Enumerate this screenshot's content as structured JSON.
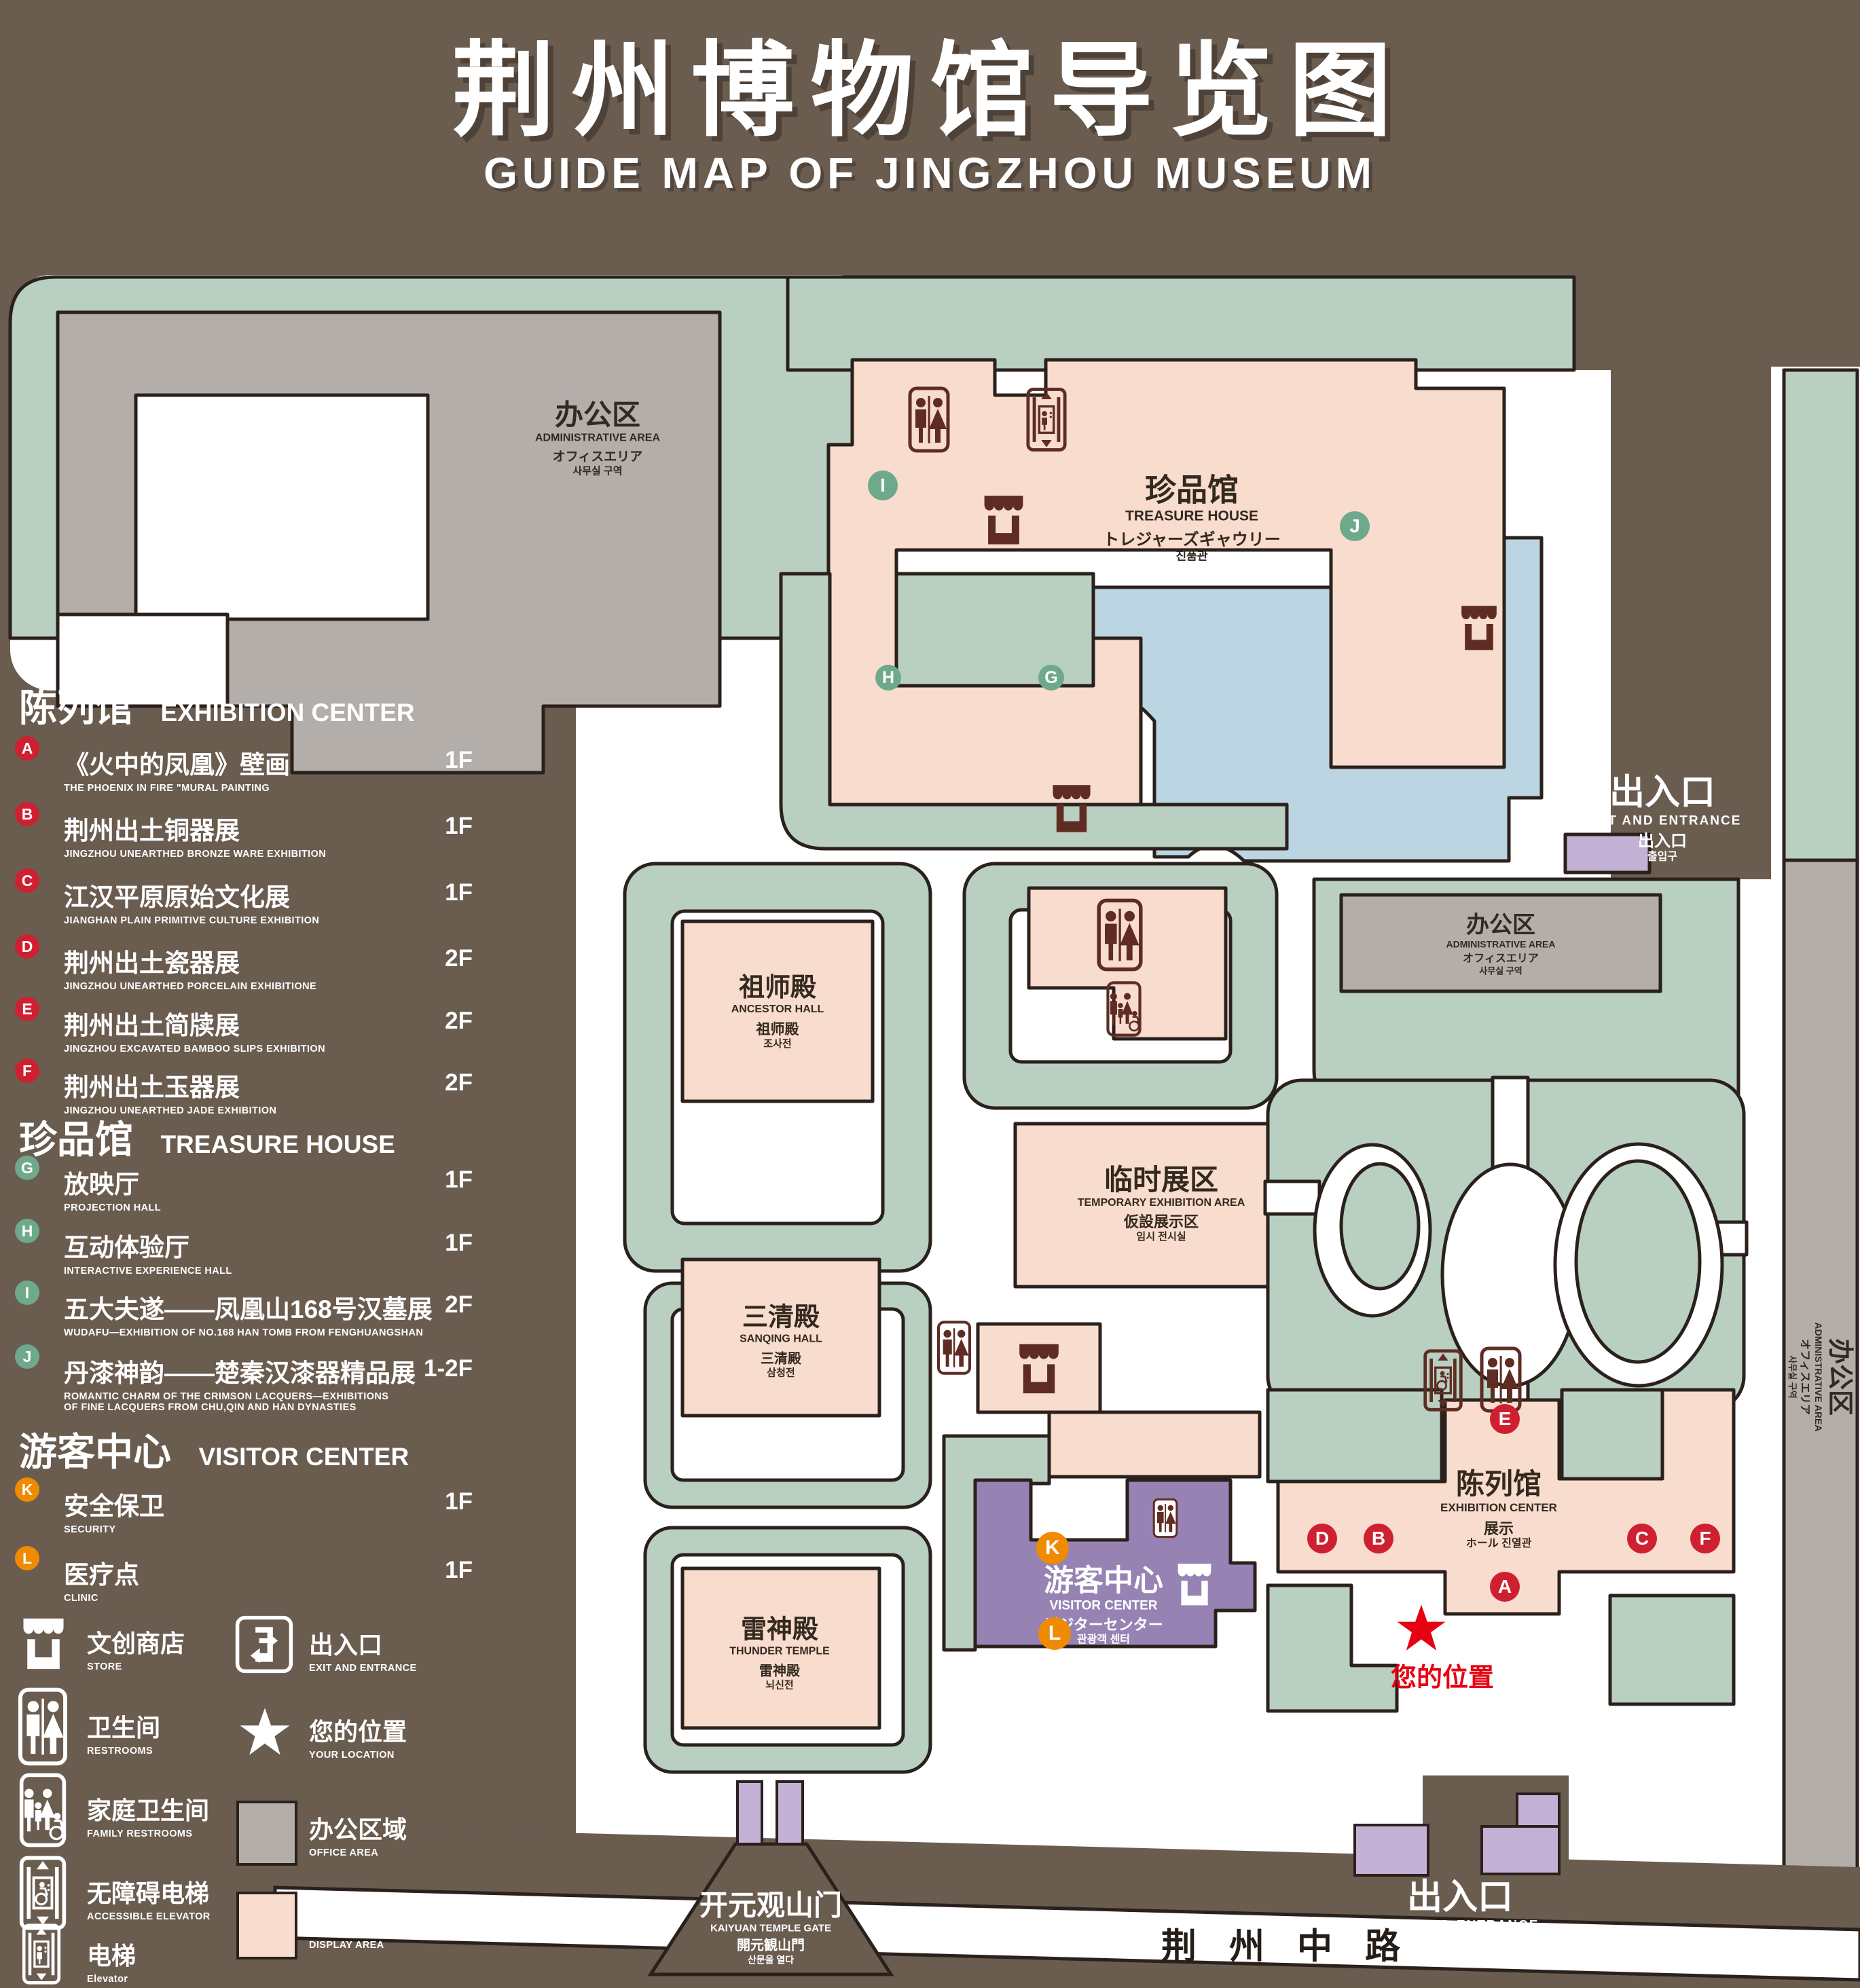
{
  "title": {
    "main": "荆州博物馆导览图",
    "sub": "GUIDE MAP OF JINGZHOU MUSEUM"
  },
  "legend": {
    "sections": [
      {
        "zh": "陈列馆",
        "en": "EXHIBITION CENTER",
        "items": [
          {
            "letter": "A",
            "zh": "《火中的凤凰》壁画",
            "en": "THE PHOENIX IN FIRE \"MURAL PAINTING",
            "floor": "1F"
          },
          {
            "letter": "B",
            "zh": "荆州出土铜器展",
            "en": "JINGZHOU UNEARTHED BRONZE WARE EXHIBITION",
            "floor": "1F"
          },
          {
            "letter": "C",
            "zh": "江汉平原原始文化展",
            "en": "JIANGHAN PLAIN PRIMITIVE CULTURE EXHIBITION",
            "floor": "1F"
          },
          {
            "letter": "D",
            "zh": "荆州出土瓷器展",
            "en": "JINGZHOU UNEARTHED PORCELAIN EXHIBITIONE",
            "floor": "2F"
          },
          {
            "letter": "E",
            "zh": "荆州出土简牍展",
            "en": "JINGZHOU EXCAVATED BAMBOO SLIPS EXHIBITION",
            "floor": "2F"
          },
          {
            "letter": "F",
            "zh": "荆州出土玉器展",
            "en": "JINGZHOU UNEARTHED JADE EXHIBITION",
            "floor": "2F"
          }
        ]
      },
      {
        "zh": "珍品馆",
        "en": "TREASURE HOUSE",
        "items": [
          {
            "letter": "G",
            "zh": "放映厅",
            "en": "PROJECTION HALL",
            "floor": "1F"
          },
          {
            "letter": "H",
            "zh": "互动体验厅",
            "en": "INTERACTIVE EXPERIENCE HALL",
            "floor": "1F"
          },
          {
            "letter": "I",
            "zh": "五大夫遂——凤凰山168号汉墓展",
            "en": "WUDAFU—EXHIBITION OF NO.168 HAN TOMB FROM FENGHUANGSHAN",
            "floor": "2F"
          },
          {
            "letter": "J",
            "zh": "丹漆神韵——楚秦汉漆器精品展",
            "en": "ROMANTIC CHARM OF THE CRIMSON LACQUERS—EXHIBITIONS",
            "en2": "OF FINE LACQUERS FROM CHU,QIN AND HAN DYNASTIES",
            "floor": "1-2F"
          }
        ]
      },
      {
        "zh": "游客中心",
        "en": "VISITOR CENTER",
        "items": [
          {
            "letter": "K",
            "zh": "安全保卫",
            "en": "SECURITY",
            "floor": "1F"
          },
          {
            "letter": "L",
            "zh": "医疗点",
            "en": "CLINIC",
            "floor": "1F"
          }
        ]
      }
    ],
    "symbols_left": [
      {
        "zh": "文创商店",
        "en": "STORE"
      },
      {
        "zh": "卫生间",
        "en": "RESTROOMS"
      },
      {
        "zh": "家庭卫生间",
        "en": "FAMILY RESTROOMS"
      },
      {
        "zh": "无障碍电梯",
        "en": "ACCESSIBLE ELEVATOR"
      },
      {
        "zh": "电梯",
        "en": "Elevator"
      }
    ],
    "symbols_right": [
      {
        "zh": "出入口",
        "en": "EXIT AND ENTRANCE"
      },
      {
        "zh": "您的位置",
        "en": "YOUR LOCATION"
      },
      {
        "zh": "办公区域",
        "en": "OFFICE AREA"
      },
      {
        "zh": "展示区域",
        "en": "DISPLAY AREA"
      }
    ]
  },
  "map": {
    "labels": {
      "admin_nw": {
        "zh": "办公区",
        "en": "ADMINISTRATIVE AREA",
        "ja": "オフィスエリア",
        "ko": "사무실 구역"
      },
      "treasure": {
        "zh": "珍品馆",
        "en": "TREASURE HOUSE",
        "ja": "トレジャーズギャウリー",
        "ko": "진품관"
      },
      "ancestor": {
        "zh": "祖师殿",
        "en": "ANCESTOR HALL",
        "zh2": "祖师殿",
        "ko": "조사전"
      },
      "temp": {
        "zh": "临时展区",
        "en": "TEMPORARY EXHIBITION AREA",
        "ja": "仮設展示区",
        "ko": "임시 전시실"
      },
      "sanqing": {
        "zh": "三清殿",
        "en": "SANQING HALL",
        "zh2": "三清殿",
        "ko": "삼청전"
      },
      "thunder": {
        "zh": "雷神殿",
        "en": "THUNDER TEMPLE",
        "zh2": "雷神殿",
        "ko": "뇌신전"
      },
      "admin_e": {
        "zh": "办公区",
        "en": "ADMINISTRATIVE AREA",
        "ja": "オフィスエリア",
        "ko": "사무실 구역"
      },
      "admin_se": {
        "zh": "办公区",
        "en": "ADMINISTRATIVE AREA",
        "ja": "オフィスエリア",
        "ko": "사무실 구역"
      },
      "exhibition": {
        "zh": "陈列馆",
        "en": "EXHIBITION CENTER",
        "zh2": "展示",
        "mix": "ホール 진열관"
      },
      "visitor": {
        "zh": "游客中心",
        "en": "VISITOR CENTER",
        "ja": "ビジターセンター",
        "ko": "관광객 센터"
      },
      "exit_ne": {
        "zh": "出入口",
        "en": "EXIT AND ENTRANCE",
        "zh2": "出入口",
        "ko": "출입구"
      },
      "exit_s": {
        "zh": "出入口",
        "en": "EXIT AND ENTRANCE",
        "zh2": "出入口",
        "ko": "출입구"
      },
      "gate": {
        "zh": "开元观山门",
        "en": "KAIYUAN TEMPLE GATE",
        "ja": "開元観山門",
        "ko": "산문을 열다"
      },
      "road": "荆州中路",
      "your_location": "您的位置"
    },
    "badges": {
      "A": "A",
      "B": "B",
      "C": "C",
      "D": "D",
      "E": "E",
      "F": "F",
      "G": "G",
      "H": "H",
      "I": "I",
      "J": "J",
      "K": "K",
      "L": "L"
    }
  },
  "colors": {
    "background": "#6B5C50",
    "campus_green": "#B8CFC1",
    "display_area": "#F8DCCD",
    "office_area": "#B3AEAA",
    "visitor_purple": "#9783B3",
    "light_purple": "#C3B1D6",
    "pond_blue": "#BCD5E2",
    "outline": "#2B211C",
    "icon_maroon": "#5E2C22",
    "badge_red": "#CE2030",
    "badge_green": "#6FA98C",
    "badge_orange": "#F08A00",
    "location_red": "#E60012"
  }
}
